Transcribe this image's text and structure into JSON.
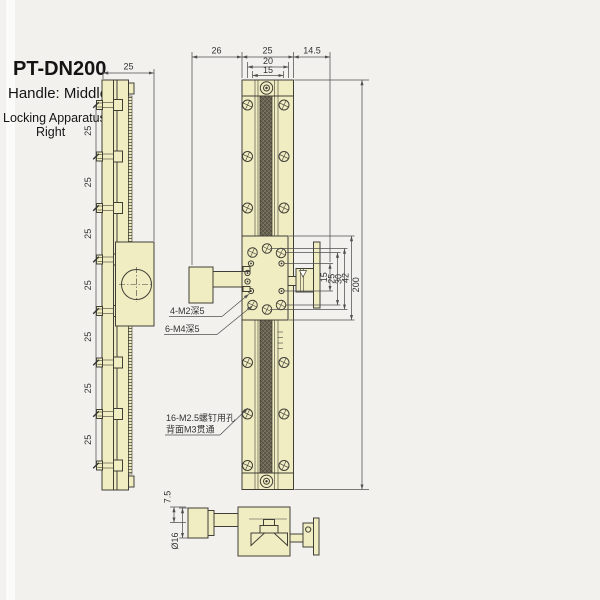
{
  "title": "PT-DN200",
  "notes": {
    "handle": "Handle: Middle",
    "locking1": "Locking Apparatus:",
    "locking2": "Right"
  },
  "colors": {
    "part_fill": "#f0edc3",
    "outline": "#403f36",
    "hatch_dark": "#6b6554",
    "dim_line": "#4f4f4f",
    "background": "#f2f1ed"
  },
  "side_view": {
    "width_dim": "25",
    "pitch_dims": [
      "25",
      "25",
      "25",
      "25",
      "25",
      "25",
      "25"
    ]
  },
  "front_view": {
    "top_dims": [
      "26",
      "25",
      "14.5"
    ],
    "plate_width_dim": "20",
    "hole_span_dim": "15",
    "right_dims": [
      "15",
      "25",
      "30",
      "42",
      "200"
    ],
    "callouts": {
      "m2": "4-M2深5",
      "m4": "6-M4深5",
      "m25_line1": "16-M2.5螺钉用孔",
      "m25_line2": "背面M3贯通"
    }
  },
  "bottom_view": {
    "offset_dim": "7.5",
    "knob_diameter_dim": "Ø16"
  }
}
